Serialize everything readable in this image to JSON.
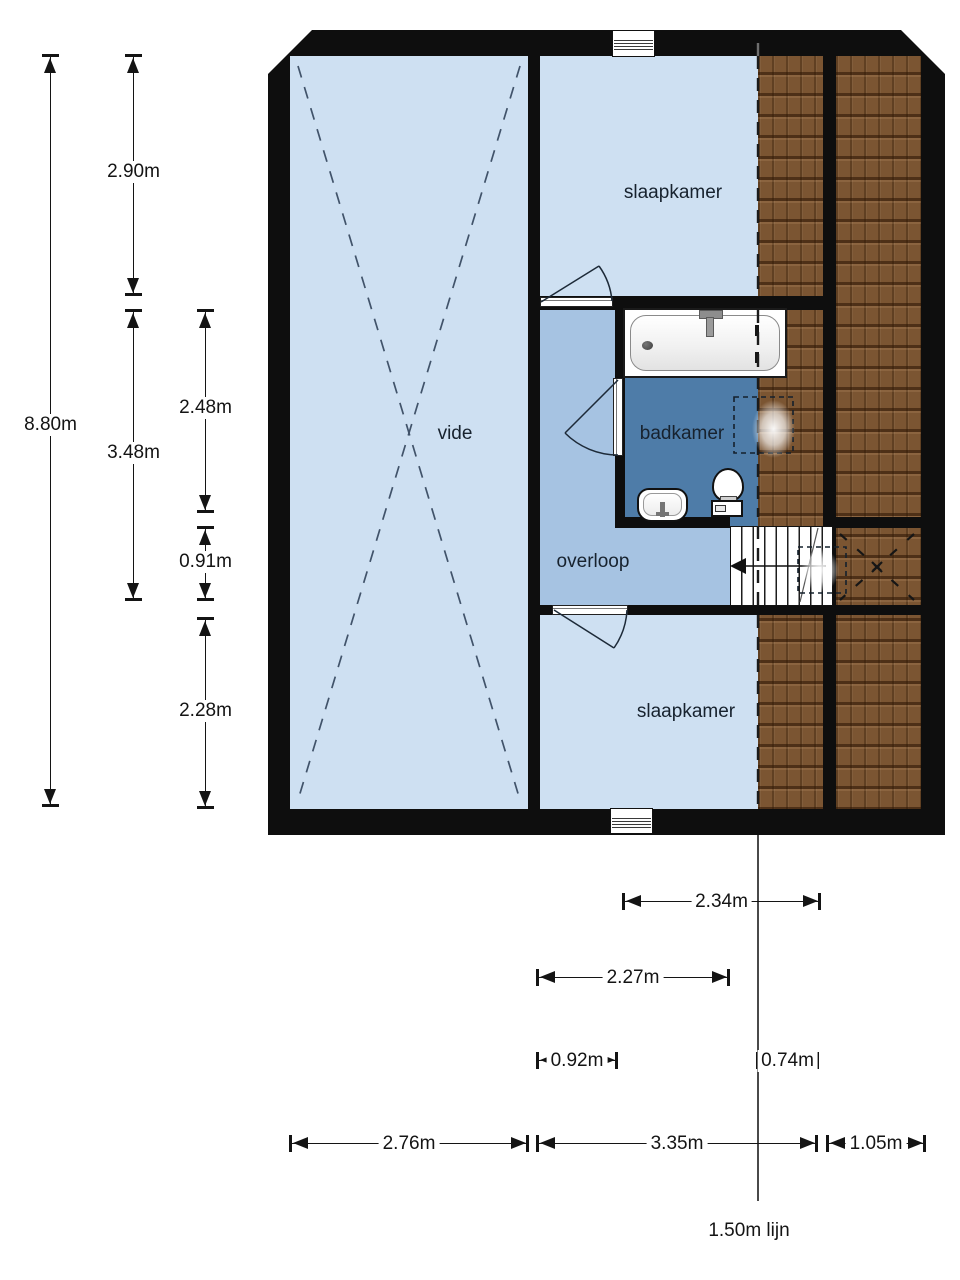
{
  "rooms": {
    "vide": "vide",
    "bedroom_top": "slaapkamer",
    "bathroom": "badkamer",
    "landing": "overloop",
    "bedroom_bottom": "slaapkamer"
  },
  "dims": {
    "v880": "8.80m",
    "v290": "2.90m",
    "v348": "3.48m",
    "v248": "2.48m",
    "v091": "0.91m",
    "v228": "2.28m",
    "h234": "2.34m",
    "h227": "2.27m",
    "h092": "0.92m",
    "h074": "0.74m",
    "h276": "2.76m",
    "h335": "3.35m",
    "h105": "1.05m",
    "line150": "1.50m lijn"
  },
  "colors": {
    "room-light": "#cee0f2",
    "room-medium": "#a6c3e2",
    "room-dark": "#4e7ca8",
    "roof-base": "#7b5532",
    "wall": "#0e0e0e",
    "dash": "#41536a",
    "ink": "#17222e"
  }
}
